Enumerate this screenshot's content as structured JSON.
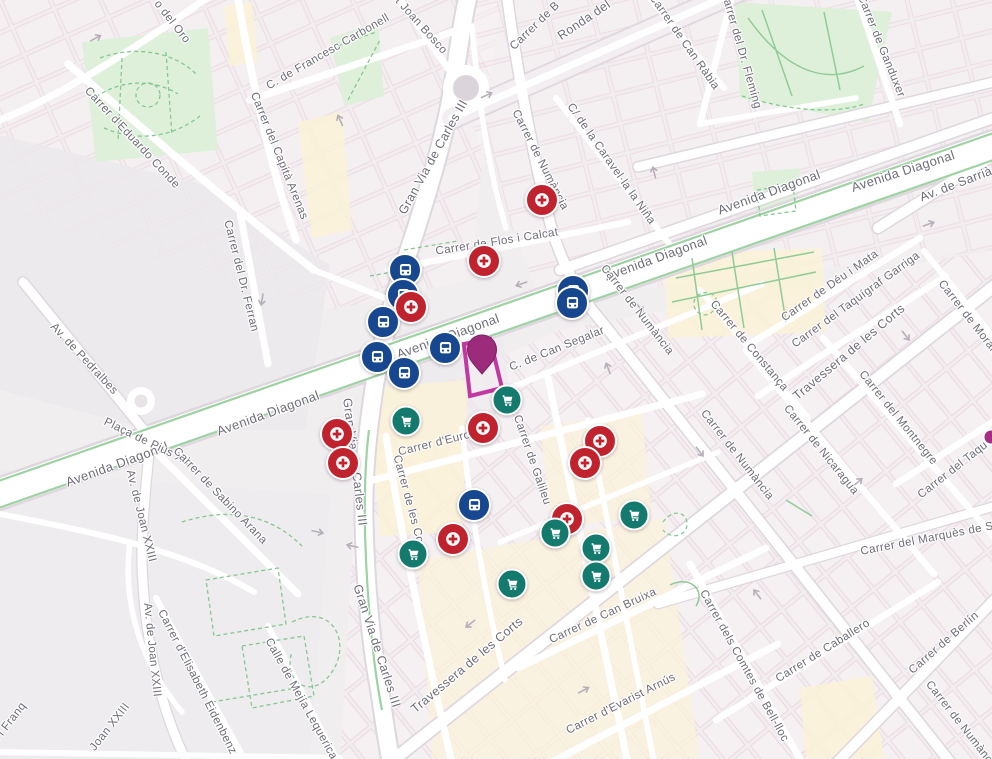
{
  "map": {
    "title": "Les Corts / Avinguda Diagonal map view",
    "colors": {
      "land": "#f1eef0",
      "road": "#ffffff",
      "park": "#dff0da",
      "commercial": "#fbf2d7",
      "label_text": "#6e6c78",
      "bus_marker": "#17478e",
      "pharmacy_marker": "#c0232e",
      "supermarket_marker": "#147a6e",
      "selected_pin": "#9c2b7c",
      "selected_outline": "#c238a2"
    },
    "streets": [
      {
        "label": "o del Oro",
        "x": 172,
        "y": 22,
        "r": 52
      },
      {
        "label": "C. de Francesc Carbonell",
        "x": 328,
        "y": 52,
        "r": -30
      },
      {
        "label": "t Joan Bosco",
        "x": 421,
        "y": 26,
        "r": 48
      },
      {
        "label": "Ronda del",
        "x": 584,
        "y": 20,
        "r": -34,
        "s": 12.5
      },
      {
        "label": "Carrer de B",
        "x": 535,
        "y": 26,
        "r": -44
      },
      {
        "label": "Carrer de Numància",
        "x": 540,
        "y": 160,
        "r": 63
      },
      {
        "label": "C/ de la Caravel·la la Niña",
        "x": 611,
        "y": 164,
        "r": 55
      },
      {
        "label": "Carrer de Flos i Calcat",
        "x": 497,
        "y": 242,
        "r": -9
      },
      {
        "label": "Carrer del Capità Arenas",
        "x": 279,
        "y": 156,
        "r": 68
      },
      {
        "label": "Carrer d'Eduardo Conde",
        "x": 132,
        "y": 138,
        "r": 47
      },
      {
        "label": "Carrer del Dr. Ferran",
        "x": 241,
        "y": 276,
        "r": 76
      },
      {
        "label": "Av. de Pedralbes",
        "x": 84,
        "y": 359,
        "r": 47
      },
      {
        "label": "Avenida Diagonal",
        "x": 117,
        "y": 464,
        "r": -20,
        "s": 13
      },
      {
        "label": "Avenida Diagonal",
        "x": 268,
        "y": 413,
        "r": -20,
        "s": 13
      },
      {
        "label": "Avenida Diagonal",
        "x": 448,
        "y": 336,
        "r": -20,
        "s": 13
      },
      {
        "label": "Avenida Diagonal",
        "x": 656,
        "y": 258,
        "r": -20,
        "s": 13
      },
      {
        "label": "Avenida Diagonal",
        "x": 769,
        "y": 192,
        "r": -20,
        "s": 13
      },
      {
        "label": "Avenida Diagonal",
        "x": 903,
        "y": 171,
        "r": -18,
        "s": 13
      },
      {
        "label": "Av. de Sarrià",
        "x": 956,
        "y": 184,
        "r": -21,
        "s": 12.5
      },
      {
        "label": "Gran Via de Carles III",
        "x": 433,
        "y": 157,
        "r": -61,
        "s": 12.5
      },
      {
        "label": "Gran Via de Carles III",
        "x": 355,
        "y": 462,
        "r": 83,
        "s": 12.5
      },
      {
        "label": "Gran Via de Carles III",
        "x": 377,
        "y": 646,
        "r": 72,
        "s": 12.5
      },
      {
        "label": "Plaça de Pius XII",
        "x": 147,
        "y": 442,
        "r": 26
      },
      {
        "label": "Carrer de Sabino Arana",
        "x": 220,
        "y": 496,
        "r": 46
      },
      {
        "label": "Av. de Joan XXIII",
        "x": 141,
        "y": 516,
        "r": 76
      },
      {
        "label": "Av. de Joan XXIII",
        "x": 152,
        "y": 650,
        "r": 84
      },
      {
        "label": "Joan XXIII",
        "x": 110,
        "y": 727,
        "r": -52
      },
      {
        "label": "í i Franq",
        "x": 10,
        "y": 722,
        "r": -52
      },
      {
        "label": "Carrer d'Elisabeth Eidenbenz",
        "x": 197,
        "y": 682,
        "r": 63
      },
      {
        "label": "Calle de Mejía Lequerica",
        "x": 301,
        "y": 699,
        "r": 61
      },
      {
        "label": "Carrer de les Corts",
        "x": 410,
        "y": 506,
        "r": 75
      },
      {
        "label": "Carrer d'Europa",
        "x": 441,
        "y": 442,
        "r": -14
      },
      {
        "label": "Carrer de Galileu",
        "x": 532,
        "y": 460,
        "r": 71
      },
      {
        "label": "C. de Can Segalar",
        "x": 557,
        "y": 349,
        "r": -22
      },
      {
        "label": "Carrer de Numància",
        "x": 637,
        "y": 310,
        "r": 52
      },
      {
        "label": "Carrer de Numància",
        "x": 737,
        "y": 455,
        "r": 52
      },
      {
        "label": "Carrer de Numància",
        "x": 962,
        "y": 726,
        "r": 52
      },
      {
        "label": "Carrer de Constança",
        "x": 749,
        "y": 346,
        "r": 50
      },
      {
        "label": "Carrer de Nicaragua",
        "x": 821,
        "y": 450,
        "r": 51
      },
      {
        "label": "Carrer del Montnegre",
        "x": 898,
        "y": 418,
        "r": 51
      },
      {
        "label": "Carrer de Morales",
        "x": 971,
        "y": 321,
        "r": 52
      },
      {
        "label": "Carrer de Déu i Mata",
        "x": 830,
        "y": 286,
        "r": -35
      },
      {
        "label": "Carrer del Taquígraf Garriga",
        "x": 856,
        "y": 300,
        "r": -36
      },
      {
        "label": "Travessera de les Corts",
        "x": 849,
        "y": 352,
        "r": -40,
        "s": 12.5
      },
      {
        "label": "Travessera de les Corts",
        "x": 467,
        "y": 665,
        "r": -40,
        "s": 12.5
      },
      {
        "label": "Carrer de Can Bruixa",
        "x": 603,
        "y": 616,
        "r": -25
      },
      {
        "label": "Carrer d'Evarist Arnús",
        "x": 621,
        "y": 704,
        "r": -27
      },
      {
        "label": "Carrer dels Comtes de Bell-lloc",
        "x": 744,
        "y": 666,
        "r": 61
      },
      {
        "label": "Carrer de Caballero",
        "x": 823,
        "y": 651,
        "r": -32
      },
      {
        "label": "Carrer del Marquès de S",
        "x": 927,
        "y": 539,
        "r": -11
      },
      {
        "label": "Carrer de Berlín",
        "x": 944,
        "y": 643,
        "r": -41
      },
      {
        "label": "Carrer del Taquígraf Serra",
        "x": 976,
        "y": 452,
        "r": -38
      },
      {
        "label": "Carrer del Dr. Fleming",
        "x": 741,
        "y": 50,
        "r": 74
      },
      {
        "label": "Carrer de Can Ràbia",
        "x": 684,
        "y": 42,
        "r": 55
      },
      {
        "label": "Carrer de Ganduxer",
        "x": 881,
        "y": 46,
        "r": 68
      }
    ],
    "markers": {
      "bus": [
        [
          405,
          270
        ],
        [
          403,
          295
        ],
        [
          383,
          322
        ],
        [
          377,
          357
        ],
        [
          404,
          373
        ],
        [
          445,
          348
        ],
        [
          573,
          291
        ],
        [
          572,
          303
        ],
        [
          474,
          505
        ]
      ],
      "medical": [
        [
          542,
          200
        ],
        [
          484,
          261
        ],
        [
          411,
          307
        ],
        [
          337,
          434
        ],
        [
          343,
          463
        ],
        [
          483,
          428
        ],
        [
          600,
          441
        ],
        [
          585,
          463
        ],
        [
          567,
          519
        ],
        [
          453,
          539
        ]
      ],
      "store": [
        [
          406,
          421
        ],
        [
          507,
          400
        ],
        [
          634,
          515
        ],
        [
          555,
          533
        ],
        [
          413,
          554
        ],
        [
          596,
          548
        ],
        [
          596,
          576
        ],
        [
          512,
          584
        ]
      ]
    },
    "highlight": {
      "pin": {
        "x": 482,
        "y": 351
      },
      "building_points": "464,344 490,339 502,388 470,396",
      "edge_marker": {
        "x": 991,
        "y": 437
      }
    }
  }
}
